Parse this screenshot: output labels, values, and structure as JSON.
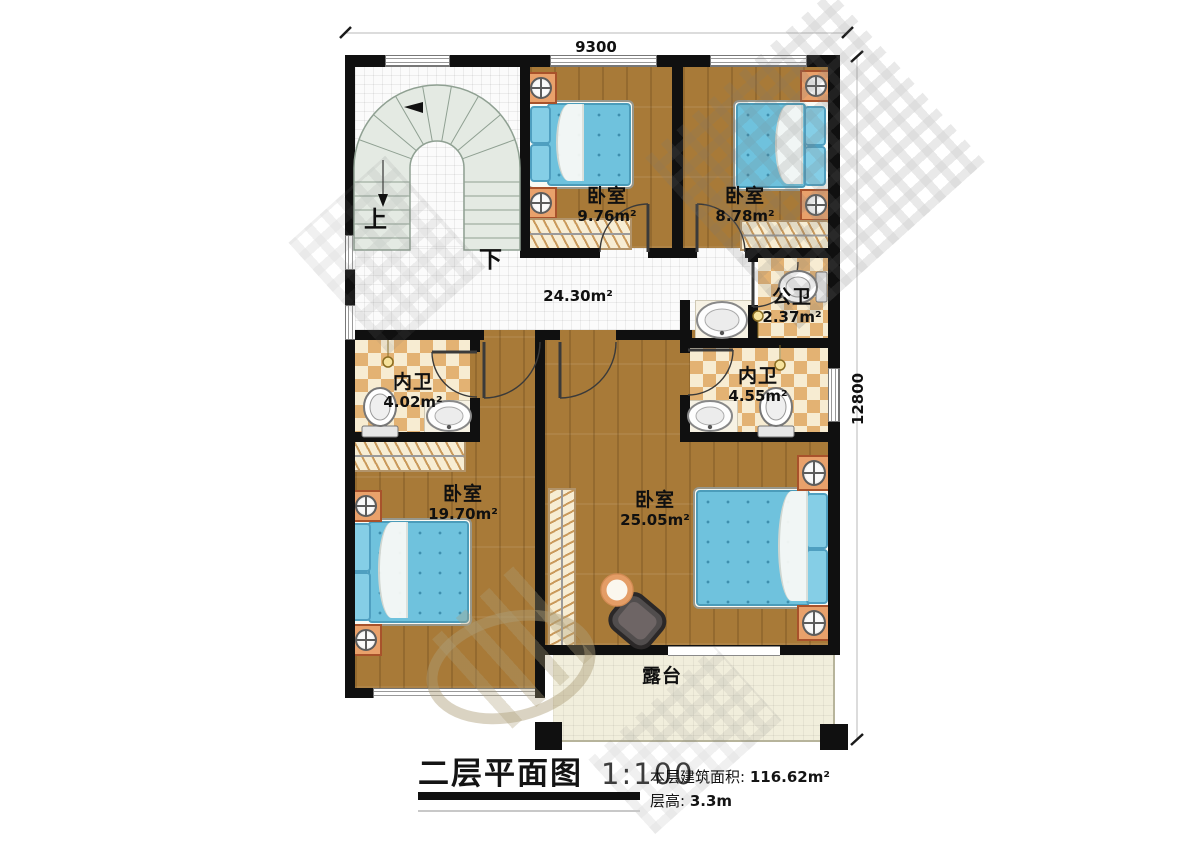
{
  "title": {
    "plan_name": "二层平面图",
    "scale": "1:100"
  },
  "info": {
    "area_label": "本层建筑面积:",
    "area_value": "116.62m²",
    "floor_height_label": "层高:",
    "floor_height_value": "3.3m"
  },
  "dimensions": {
    "width": "9300",
    "height": "12800"
  },
  "rooms": {
    "bedroom_tl": {
      "name": "卧室",
      "area": "9.76m²"
    },
    "bedroom_tr": {
      "name": "卧室",
      "area": "8.78m²"
    },
    "hall": {
      "area": "24.30m²"
    },
    "public_bath": {
      "name": "公卫",
      "area": "2.37m²"
    },
    "ensuite_left": {
      "name": "内卫",
      "area": "4.02m²"
    },
    "ensuite_right": {
      "name": "内卫",
      "area": "4.55m²"
    },
    "bedroom_bl": {
      "name": "卧室",
      "area": "19.70m²"
    },
    "bedroom_br": {
      "name": "卧室",
      "area": "25.05m²"
    },
    "terrace": {
      "name": "露台"
    }
  },
  "stairs": {
    "up": "上",
    "down": "下"
  },
  "colors": {
    "wall": "#101010",
    "wood_floor": "#a87a38",
    "bath_tile_dark": "#e3b273",
    "bath_tile_light": "#f7ecd2",
    "mattress_blue": "#6fc2dd",
    "stair_fill": "#e4eae3",
    "terrace_tile": "#f1eedc",
    "nightstand_orange": "#e9a16b"
  }
}
